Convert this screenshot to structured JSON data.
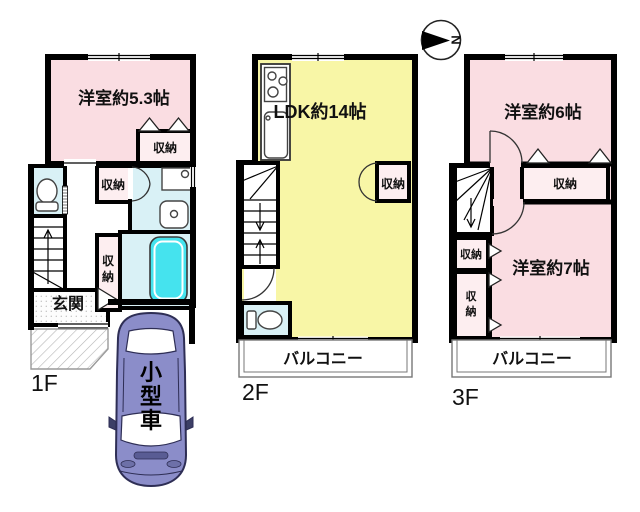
{
  "compass": {
    "north": "N"
  },
  "car": {
    "label": "小型車"
  },
  "floor1": {
    "name": "1F",
    "bedroom": "洋室約5.3帖",
    "bedroom_closet": "収納",
    "hall_closet": "収納",
    "corridor_closet": "収納",
    "entrance": "玄関"
  },
  "floor2": {
    "name": "2F",
    "ldk": "LDK約14帖",
    "closet": "収納",
    "balcony": "バルコニー"
  },
  "floor3": {
    "name": "3F",
    "bedroom6": "洋室約6帖",
    "bedroom7": "洋室約7帖",
    "closet_main": "収納",
    "closet_left_upper": "収納",
    "closet_left_lower": "収納",
    "balcony": "バルコニー"
  },
  "colors": {
    "room_pink": "#fadde2",
    "closet_pink": "#fdeef0",
    "ldk_yellow": "#f8f6a6",
    "wet_area_blue": "#d9f1f6",
    "bathtub_cyan": "#45e3ee",
    "car_body": "#8b8dc9",
    "wall": "#000000"
  }
}
